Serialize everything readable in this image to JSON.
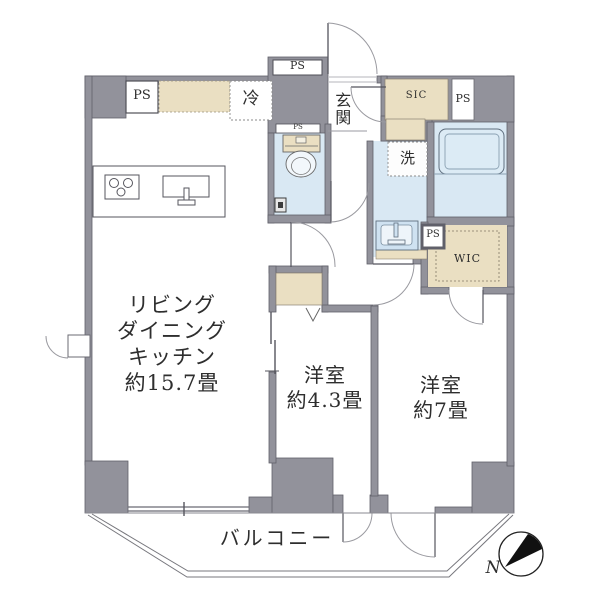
{
  "plan": {
    "type": "apartment-floor-plan",
    "labels": {
      "ldk_lines": [
        "リビング",
        "ダイニング",
        "キッチン",
        "約15.7畳"
      ],
      "bedroom1_lines": [
        "洋室",
        "約4.3畳"
      ],
      "bedroom2_lines": [
        "洋室",
        "約7畳"
      ],
      "balcony": "バルコニー",
      "entrance": "玄関",
      "laundry": "洗",
      "refrigerator": "冷",
      "shoe_closet": "SIC",
      "walk_in_closet": "WIC",
      "ps_kitchen": "PS",
      "ps_top": "PS",
      "ps_toilet": "PS",
      "ps_entry": "PS",
      "ps_wic": "PS",
      "compass_north": "N"
    },
    "colors": {
      "wall": "#92929b",
      "wall_outline": "#60606a",
      "water_area": "#d9e8f3",
      "storage_beige": "#eadfc2",
      "line": "#6b6b73",
      "text": "#2e2e2e"
    }
  }
}
